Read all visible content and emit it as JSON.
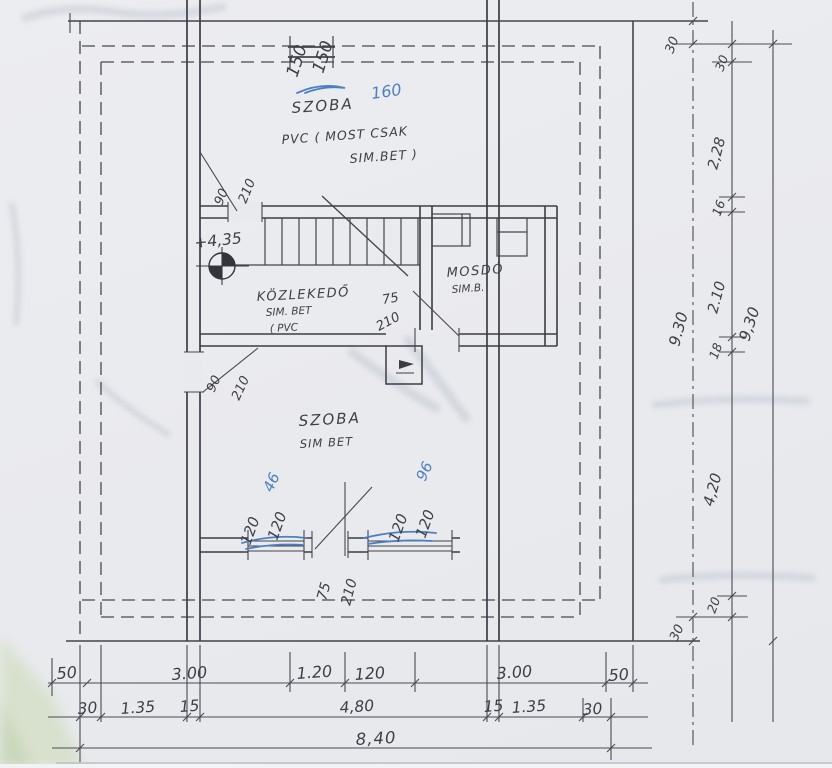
{
  "palette": {
    "paper": "#e9eaee",
    "pencil": "#44444b",
    "ink_blue": "#4e80c1",
    "green_corner": "#d6e0ca"
  },
  "plan": {
    "room_top": {
      "name": "SZOBA",
      "note1": "PVC ( MOST CSAK",
      "note2": "SIM.BET )"
    },
    "corridor": {
      "name": "KÖZLEKEDŐ",
      "note1": "SIM. BET",
      "note2": "( PVC"
    },
    "washroom": {
      "name": "MOSDÓ",
      "note1": "SIM.B."
    },
    "room_bottom": {
      "name": "SZOBA",
      "note1": "SIM BET"
    },
    "level_mark": "+4,35"
  },
  "openings": {
    "window_top": {
      "w": "150",
      "h": "150"
    },
    "door_top_left": {
      "w": "90",
      "h": "210"
    },
    "door_corridor": {
      "w": "75",
      "h": "210"
    },
    "door_mid_left": {
      "w": "90",
      "h": "210"
    },
    "window_bottom_left": {
      "w": "120",
      "h": "120"
    },
    "window_bottom_right": {
      "w": "120",
      "h": "120"
    },
    "door_bottom": {
      "w": "75",
      "h": "210"
    }
  },
  "ink_notes": {
    "top": "160",
    "bottom_left": "46",
    "bottom_right": "96"
  },
  "dims": {
    "row1": [
      "50",
      "3.00",
      "1.20",
      "120",
      "3.00",
      "50"
    ],
    "row2": [
      "30",
      "1.35",
      "15",
      "4,80",
      "15",
      "1.35",
      "30"
    ],
    "total_width": "8,40",
    "right_inner_top": "30",
    "right_inner_mid": "9.30",
    "right_inner_bottom": "30",
    "right_mid": [
      "30",
      "2,28",
      "16",
      "2.10",
      "18",
      "4,20",
      "20"
    ],
    "right_total": "9,30"
  }
}
